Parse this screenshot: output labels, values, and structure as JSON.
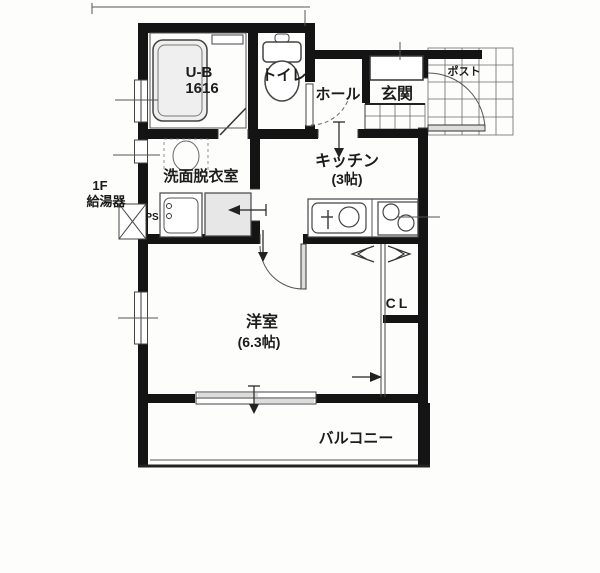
{
  "colors": {
    "wall": "#141414",
    "line": "#3a3a3a",
    "fixture_fill": "#e7e7e7",
    "door_leaf": "#dddddd",
    "background": "#fdfdfc",
    "text": "#1c1c1c"
  },
  "floor_plan": {
    "unit_bath": {
      "name": "U-B",
      "size": "1616"
    },
    "toilet": {
      "label": "トイレ"
    },
    "hall": {
      "label": "ホール"
    },
    "entrance": {
      "label": "玄関"
    },
    "post_box": {
      "label": "ポスト"
    },
    "kitchen": {
      "name": "キッチン",
      "size": "(3帖)"
    },
    "washroom": {
      "label": "洗面脱衣室"
    },
    "water_heater": {
      "line1": "1F",
      "line2": "給湯器"
    },
    "pipe_space": {
      "label": "PS"
    },
    "closet": {
      "label": "CL"
    },
    "western_room": {
      "name": "洋室",
      "size": "(6.3帖)"
    },
    "balcony": {
      "label": "バルコニー"
    }
  }
}
